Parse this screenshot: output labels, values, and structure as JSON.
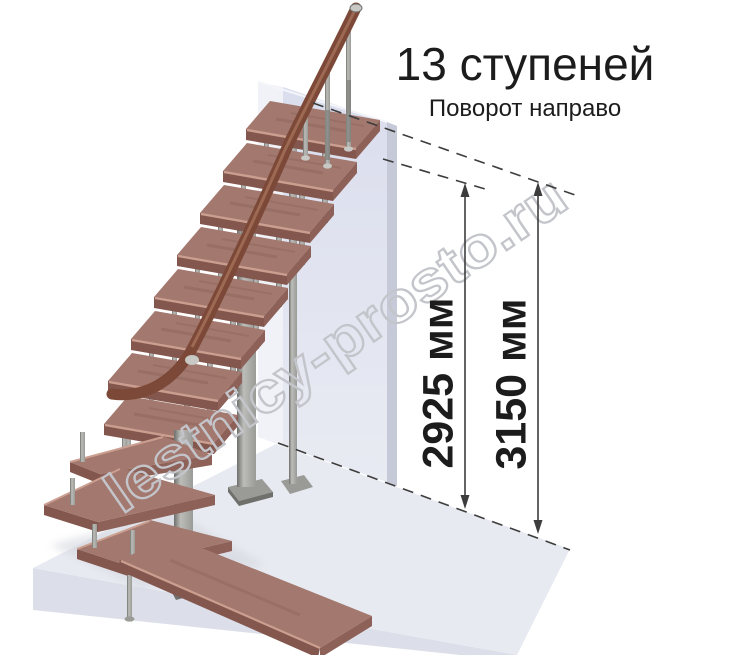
{
  "header": {
    "title": "13 ступеней",
    "subtitle": "Поворот направо"
  },
  "dimensions": {
    "to_top_step": "2925 мм",
    "total_height": "3150 мм"
  },
  "watermark": "lestnicy-prosto.ru",
  "colors": {
    "titleColor": "#1c1c1c",
    "dimColor": "#3d3d3d",
    "watermarkStroke": "#c3c5cb",
    "wallFront": "#dadded",
    "wallFrontLight": "#e9ebf3",
    "wallLeft": "#f0f2f8",
    "wallRight": "#c6cad8",
    "floorTop": "#e8eaf1",
    "floorFront": "#dcdfe9",
    "shadow": "#d4d6de",
    "treadTop": "#a3786e",
    "treadFront": "#84574e",
    "treadRight": "#8d6058",
    "treadEdge": "#cb9f90",
    "metalLight": "#bcbcb9",
    "metalMid": "#9a9a97",
    "metalDark": "#6f6f6c",
    "collar": "#c8c8c5",
    "rail": "#7c4938",
    "railLight": "#a5725a"
  }
}
